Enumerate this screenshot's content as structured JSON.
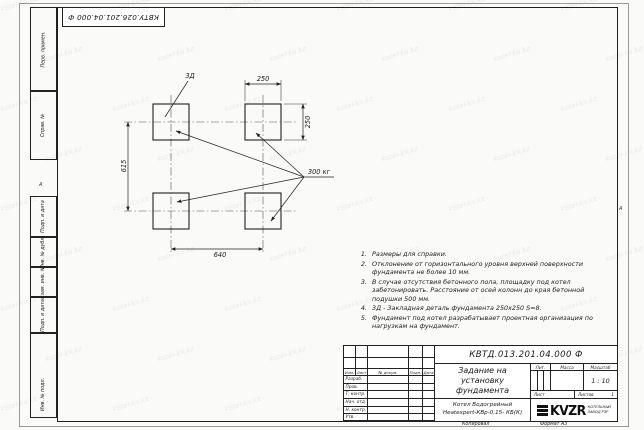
{
  "watermark": {
    "text": "kotel-kv.kz"
  },
  "top_stamp": {
    "reference": "КВТУ.026.201.04.000 Ф"
  },
  "zone_markers": {
    "left": "А",
    "right": "А"
  },
  "margin": {
    "items": [
      "Перв. примен.",
      "Справ. №",
      "Подп. и дата",
      "Инв. № дубл.",
      "Взам. инв. №",
      "Подп. и дата",
      "Инв. № подл."
    ]
  },
  "drawing": {
    "embed_label": "3Д",
    "load_label": "300 кг",
    "dim_top_width": "250",
    "dim_right_height": "250",
    "dim_left_spacing": "615",
    "dim_bottom_spacing": "640"
  },
  "notes": {
    "items": [
      "Размеры для справки.",
      "Отклонение от горизонтального уровня верхней поверхности фундамента не более 10 мм.",
      "В случае отсутствия бетонного пола, площадку под котел забетонировать. Расстояние от осей колонн до края бетонной подушки 500 мм.",
      "3Д - Закладная деталь фундамента 250х250 S=8.",
      "Фундамент под котел разрабатывает проектная организация по нагрузкам на фундамент."
    ]
  },
  "title_block": {
    "doc_number": "КВТД.013.201.04.000 Ф",
    "title": "Задание на установку фундамента",
    "change_cols": [
      "Изм.",
      "Лист",
      "№ докум.",
      "Подп.",
      "Дата"
    ],
    "sig_rows": [
      "Разраб.",
      "Пров.",
      "Т. контр.",
      "Нач. отд.",
      "Н. контр.",
      "Утв."
    ],
    "lit_label": "Лит.",
    "mass_label": "Масса",
    "scale_label": "Масштаб",
    "scale_value": "1 : 10",
    "sheet_label": "Лист",
    "sheets_label": "Листов",
    "sheets_value": "1",
    "product_line1": "Котел Водогрейный",
    "product_line2": "Heatexpert-КВр-0,15- КБ(К)",
    "logo_text": "KVZR",
    "logo_caption1": "КОТЕЛЬНЫЙ",
    "logo_caption2": "ЗАВОД РЗР"
  },
  "footer": {
    "copied_label": "Копировал",
    "format_label": "Формат А3"
  }
}
